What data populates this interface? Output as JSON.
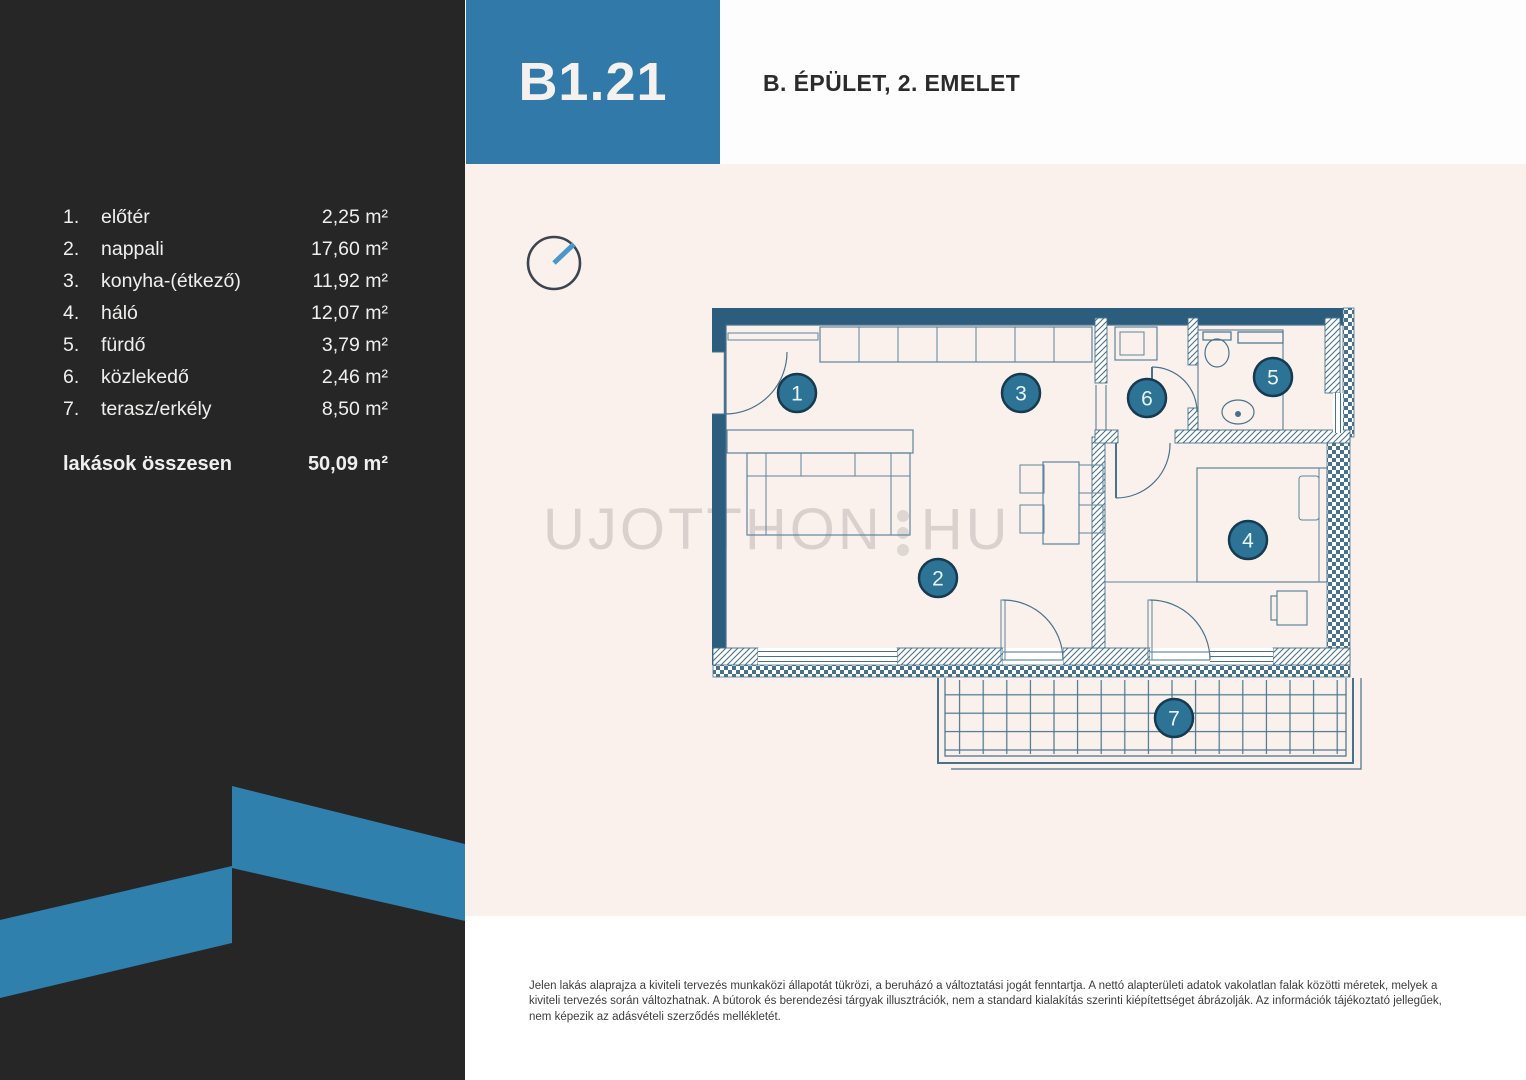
{
  "header": {
    "unit_code": "B1.21",
    "building_floor": "B. ÉPÜLET, 2. EMELET"
  },
  "room_list": {
    "rows": [
      {
        "num": "1.",
        "label": "előtér",
        "area": "2,25 m²"
      },
      {
        "num": "2.",
        "label": "nappali",
        "area": "17,60 m²"
      },
      {
        "num": "3.",
        "label": "konyha-(étkező)",
        "area": "11,92 m²"
      },
      {
        "num": "4.",
        "label": "háló",
        "area": "12,07 m²"
      },
      {
        "num": "5.",
        "label": "fürdő",
        "area": "3,79 m²"
      },
      {
        "num": "6.",
        "label": "közlekedő",
        "area": "2,46 m²"
      },
      {
        "num": "7.",
        "label": "terasz/erkély",
        "area": "8,50 m²"
      }
    ],
    "total": {
      "label": "lakások összesen",
      "area": "50,09 m²"
    }
  },
  "floor_plan": {
    "markers": [
      "1",
      "2",
      "3",
      "4",
      "5",
      "6",
      "7"
    ],
    "watermark": {
      "left": "UJOTTHON",
      "right": "HU"
    }
  },
  "footer": {
    "disclaimer": "Jelen lakás alaprajza a kiviteli tervezés munkaközi állapotát tükrözi, a beruházó a változtatási jogát fenntartja. A nettó alapterületi adatok vakolatlan falak közötti méretek, melyek a kiviteli tervezés során változhatnak. A bútorok és berendezési tárgyak illusztrációk, nem a standard kialakítás szerinti kiépítettséget ábrázolják. Az információk tájékoztató jellegűek, nem képezik az adásvételi szerződés mellékletét."
  },
  "colors": {
    "accent": "#3179a8",
    "panel_bg": "#262627",
    "plan_bg": "#fbf1ec",
    "wall": "#2c5d7d",
    "line": "#48728c",
    "marker_fill": "#2d7396",
    "marker_ring": "#163a4f",
    "text_light": "#f0efed",
    "text_dark": "#2b2b2b"
  }
}
